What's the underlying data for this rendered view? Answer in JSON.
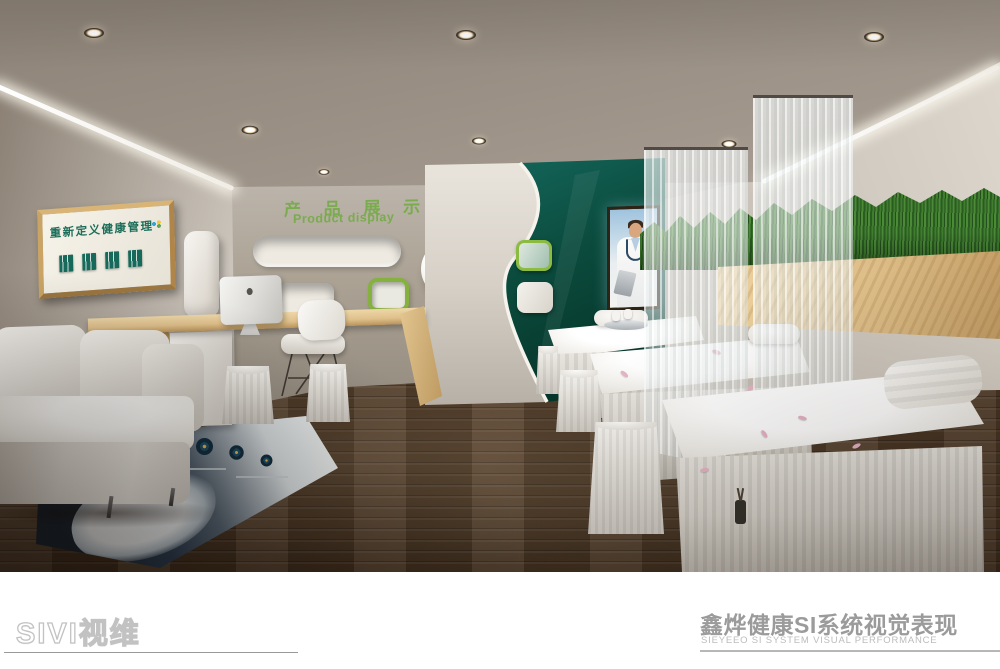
{
  "footer": {
    "logo_text": "SIVI视维",
    "title_cn": "鑫烨健康SI系统视觉表现",
    "title_en": "SIEYEEO SI SYSTEM VISUAL PERFORMANCE"
  },
  "wall_sign": {
    "title": "重新定义健康管理",
    "badge_count": 4
  },
  "product_wall": {
    "title_cn": "产 品 展 示",
    "title_en": "Product display"
  },
  "colors": {
    "accent_green": "#7aab4e",
    "sign_green": "#1d6e5a",
    "dark_teal": "#0d574a",
    "shelf_green_border": "#85b13e",
    "wood_desk": "#dfc08b",
    "floor_wood": "#4c3724",
    "footer_gray": "#9b9b9b",
    "footer_sub_gray": "#bcbcbc"
  }
}
